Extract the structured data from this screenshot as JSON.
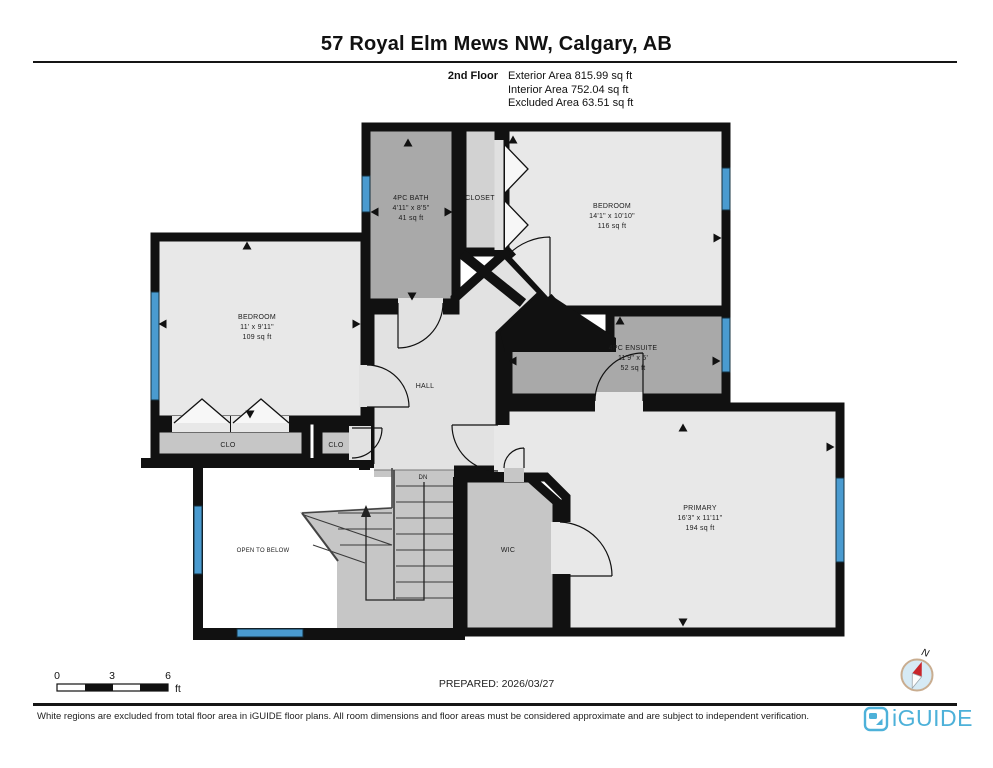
{
  "header": {
    "title": "57 Royal Elm Mews NW, Calgary, AB",
    "floor_label": "2nd Floor",
    "area_lines": [
      "Exterior Area 815.99 sq ft",
      "Interior Area 752.04 sq ft",
      "Excluded Area 63.51 sq ft"
    ]
  },
  "plan": {
    "rooms": {
      "bath": {
        "name": "4PC BATH",
        "dims": "4'11\" x 8'5\"",
        "area": "41 sq ft"
      },
      "closet": {
        "name": "CLOSET"
      },
      "bedroom2": {
        "name": "BEDROOM",
        "dims": "14'1\" x 10'10\"",
        "area": "116 sq ft"
      },
      "bedroom1": {
        "name": "BEDROOM",
        "dims": "11' x 9'11\"",
        "area": "109 sq ft"
      },
      "hall": {
        "name": "HALL"
      },
      "ensuite": {
        "name": "4PC ENSUITE",
        "dims": "11'9\" x 5'",
        "area": "52 sq ft"
      },
      "clo_left": {
        "name": "CLO"
      },
      "clo_right": {
        "name": "CLO"
      },
      "open_below": {
        "name": "OPEN TO BELOW"
      },
      "wic": {
        "name": "WIC"
      },
      "primary": {
        "name": "PRIMARY",
        "dims": "16'3\" x 11'11\"",
        "area": "194 sq ft"
      }
    },
    "stairs": {
      "label": "DN"
    }
  },
  "scale_bar": {
    "ticks": [
      "0",
      "3",
      "6"
    ],
    "unit": "ft"
  },
  "compass": {
    "label": "N"
  },
  "footer": {
    "prepared": "PREPARED: 2026/03/27",
    "disclaimer": "White regions are excluded from total floor area in iGUIDE floor plans. All room dimensions and floor areas must be considered approximate and are subject to independent verification.",
    "brand": "iGUIDE"
  },
  "colors": {
    "wall": "#111111",
    "room_light": "#e8e8e8",
    "room_medium": "#c6c6c6",
    "room_dark": "#a9a9a9",
    "window_blue": "#4a9bd0",
    "logo_blue": "#4db1d9",
    "compass_red": "#c9252b"
  }
}
